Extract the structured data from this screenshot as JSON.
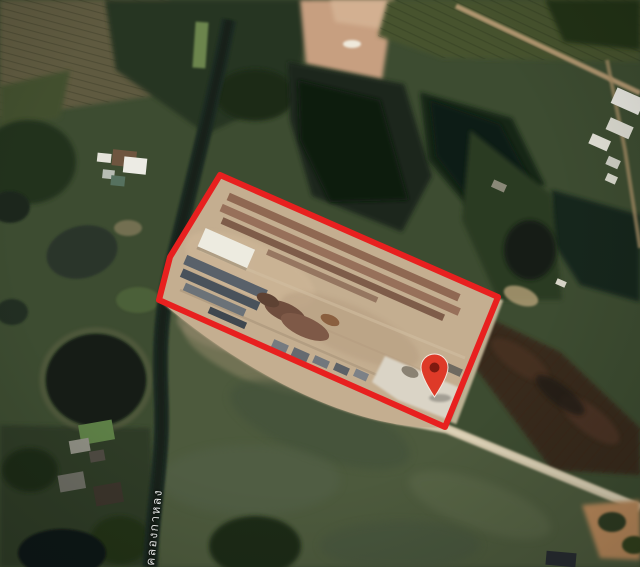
{
  "map": {
    "view_type": "satellite",
    "canal_label": "คลองกาหลง",
    "boundary": {
      "points": "220,175 498,297 445,427 159,300 170,257",
      "color": "#e8201f",
      "stroke_width": "6"
    },
    "marker": {
      "transform": "translate(421,354)",
      "color": "#de3a28",
      "hole_color": "#7e1a10",
      "outline_color": "#f2e9df"
    },
    "palette": {
      "water_dark": "#131c16",
      "canal": "#1d2b20",
      "field_green": "#4d5a3c",
      "woods_dark": "#273520",
      "site_tan": "#c4ae90",
      "road_tan": "#d3c7ab"
    }
  }
}
